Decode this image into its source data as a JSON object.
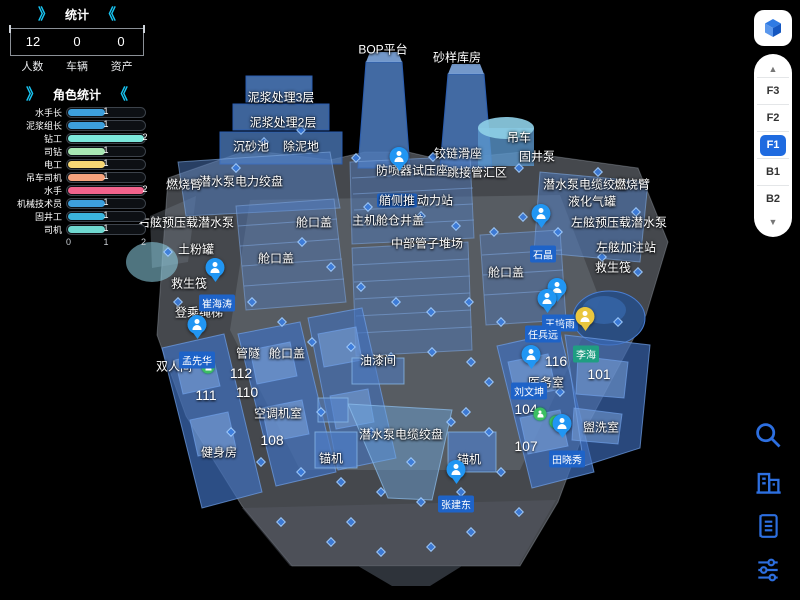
{
  "ui": {
    "chev_open": "》",
    "chev_close": "《",
    "up_arrow": "▲",
    "down_arrow": "▼"
  },
  "stats_panel": {
    "title": "统计",
    "items": [
      {
        "value": "12",
        "label": "人数"
      },
      {
        "value": "0",
        "label": "车辆"
      },
      {
        "value": "0",
        "label": "资产"
      }
    ]
  },
  "role_chart": {
    "title": "角色统计",
    "type": "bar",
    "x_max": 2,
    "x_ticks": [
      "0",
      "1",
      "2"
    ],
    "items": [
      {
        "label": "水手长",
        "value": 1,
        "color": "#3d9fdc"
      },
      {
        "label": "泥浆组长",
        "value": 1,
        "color": "#3d9fdc"
      },
      {
        "label": "钻工",
        "value": 2,
        "color": "#7ce8dc"
      },
      {
        "label": "司钻",
        "value": 1,
        "color": "#a9e8b4"
      },
      {
        "label": "电工",
        "value": 1,
        "color": "#f7d774"
      },
      {
        "label": "吊车司机",
        "value": 1,
        "color": "#f5a27c"
      },
      {
        "label": "水手",
        "value": 2,
        "color": "#f2638c"
      },
      {
        "label": "机械技术员",
        "value": 1,
        "color": "#3d9fdc"
      },
      {
        "label": "固井工",
        "value": 1,
        "color": "#3bb4dc"
      },
      {
        "label": "司机",
        "value": 1,
        "color": "#6fd8d0"
      }
    ]
  },
  "floor_selector": {
    "options": [
      {
        "label": "F3",
        "active": false
      },
      {
        "label": "F2",
        "active": false
      },
      {
        "label": "F1",
        "active": true
      },
      {
        "label": "B1",
        "active": false
      },
      {
        "label": "B2",
        "active": false
      }
    ],
    "active_color": "#1f6be0"
  },
  "toolbar": {
    "color": "#2d6fe0",
    "icons": [
      "search",
      "building",
      "list",
      "filters"
    ]
  },
  "map": {
    "labels": [
      {
        "t": "BOP平台",
        "x": 383,
        "y": 49
      },
      {
        "t": "砂样库房",
        "x": 457,
        "y": 57
      },
      {
        "t": "泥浆处理3层",
        "x": 281,
        "y": 97
      },
      {
        "t": "泥浆处理2层",
        "x": 283,
        "y": 122
      },
      {
        "t": "沉砂池",
        "x": 251,
        "y": 146
      },
      {
        "t": "除泥地",
        "x": 301,
        "y": 146
      },
      {
        "t": "吊车",
        "x": 519,
        "y": 137
      },
      {
        "t": "铰链滑座",
        "x": 458,
        "y": 153
      },
      {
        "t": "固井泵",
        "x": 537,
        "y": 156
      },
      {
        "t": "跳接管汇区",
        "x": 477,
        "y": 172
      },
      {
        "t": "防喷器试压座",
        "x": 412,
        "y": 170
      },
      {
        "t": "潜水泵电缆绞盘",
        "x": 585,
        "y": 184
      },
      {
        "t": "燃烧臂",
        "x": 632,
        "y": 184
      },
      {
        "t": "燃烧臂",
        "x": 184,
        "y": 184
      },
      {
        "t": "潜水泵电力绞盘",
        "x": 241,
        "y": 181
      },
      {
        "t": "液化气罐",
        "x": 592,
        "y": 201
      },
      {
        "t": "左舷预压载潜水泵",
        "x": 619,
        "y": 222
      },
      {
        "t": "右舷预压载潜水泵",
        "x": 186,
        "y": 222
      },
      {
        "t": "主机舱仓井盖",
        "x": 388,
        "y": 220
      },
      {
        "t": "动力站",
        "hl": "艏侧推",
        "x": 415,
        "y": 200
      },
      {
        "t": "中部管子堆场",
        "x": 427,
        "y": 243
      },
      {
        "t": "土粉罐",
        "x": 196,
        "y": 249
      },
      {
        "t": "舱口盖",
        "x": 314,
        "y": 222
      },
      {
        "t": "舱口盖",
        "x": 276,
        "y": 258
      },
      {
        "t": "舱口盖",
        "x": 506,
        "y": 272
      },
      {
        "t": "舱口盖",
        "x": 287,
        "y": 353
      },
      {
        "t": "左舷加注站",
        "x": 626,
        "y": 247
      },
      {
        "t": "救生筏",
        "x": 613,
        "y": 267
      },
      {
        "t": "救生筏",
        "x": 189,
        "y": 283
      },
      {
        "t": "登乘绳梯",
        "x": 199,
        "y": 312
      },
      {
        "t": "双人间",
        "x": 174,
        "y": 366
      },
      {
        "t": "管隧",
        "x": 248,
        "y": 353
      },
      {
        "t": "油漆间",
        "x": 378,
        "y": 360
      },
      {
        "t": "空调机室",
        "x": 278,
        "y": 413
      },
      {
        "t": "健身房",
        "x": 219,
        "y": 452
      },
      {
        "t": "锚机",
        "x": 331,
        "y": 458
      },
      {
        "t": "锚机",
        "x": 469,
        "y": 459
      },
      {
        "t": "潜水泵电缆绞盘",
        "x": 401,
        "y": 434
      },
      {
        "t": "医务室",
        "x": 546,
        "y": 382
      },
      {
        "t": "盥洗室",
        "x": 601,
        "y": 427
      },
      {
        "t": "112",
        "k": "n",
        "x": 241,
        "y": 373
      },
      {
        "t": "111",
        "k": "n",
        "x": 206,
        "y": 395
      },
      {
        "t": "110",
        "k": "n",
        "x": 247,
        "y": 392
      },
      {
        "t": "108",
        "k": "n",
        "x": 272,
        "y": 440
      },
      {
        "t": "116",
        "k": "n",
        "x": 556,
        "y": 361
      },
      {
        "t": "101",
        "k": "n",
        "x": 599,
        "y": 374
      },
      {
        "t": "104",
        "k": "n",
        "x": 526,
        "y": 409
      },
      {
        "t": "107",
        "k": "n",
        "x": 526,
        "y": 446
      }
    ],
    "persons": [
      {
        "name": "崔海涛",
        "pin": [
          215,
          277
        ],
        "label": [
          217,
          303
        ]
      },
      {
        "name": "孟先华",
        "pin": [
          197,
          334
        ],
        "label": [
          197,
          360
        ]
      },
      {
        "name": "石晶",
        "pin": [
          541,
          223
        ],
        "label": [
          543,
          254
        ]
      },
      {
        "name": "王培雨",
        "pin": [
          557,
          297
        ],
        "label": [
          560,
          323
        ]
      },
      {
        "name": "任兵远",
        "pin": [
          547,
          308
        ],
        "label": [
          543,
          334
        ]
      },
      {
        "name": "李海",
        "pin": [
          585,
          326
        ],
        "label": [
          586,
          354
        ],
        "pin_color": "#eac63e",
        "label_color": "#1f9e82"
      },
      {
        "name": "刘文坤",
        "pin": [
          531,
          364
        ],
        "label": [
          529,
          391
        ]
      },
      {
        "name": "田晓秀",
        "pin": [
          562,
          433
        ],
        "label": [
          567,
          459
        ]
      },
      {
        "name": "张建东",
        "pin": [
          456,
          479
        ],
        "label": [
          456,
          504
        ]
      },
      {
        "name": "",
        "pin": [
          399,
          166
        ],
        "label": null
      }
    ],
    "person_pin_color": "#2196f3",
    "person_label_color": "#1e63c8",
    "green_markers": [
      [
        208,
        367
      ],
      [
        540,
        414
      ],
      [
        556,
        422
      ]
    ],
    "crowd": [
      [
        236,
        168
      ],
      [
        264,
        142
      ],
      [
        301,
        130
      ],
      [
        356,
        158
      ],
      [
        433,
        157
      ],
      [
        519,
        168
      ],
      [
        598,
        172
      ],
      [
        636,
        212
      ],
      [
        368,
        207
      ],
      [
        421,
        216
      ],
      [
        456,
        226
      ],
      [
        494,
        232
      ],
      [
        523,
        217
      ],
      [
        558,
        232
      ],
      [
        602,
        257
      ],
      [
        638,
        272
      ],
      [
        302,
        242
      ],
      [
        331,
        267
      ],
      [
        361,
        287
      ],
      [
        396,
        302
      ],
      [
        431,
        312
      ],
      [
        469,
        302
      ],
      [
        501,
        322
      ],
      [
        252,
        302
      ],
      [
        282,
        322
      ],
      [
        312,
        342
      ],
      [
        351,
        347
      ],
      [
        391,
        357
      ],
      [
        432,
        352
      ],
      [
        471,
        362
      ],
      [
        231,
        432
      ],
      [
        261,
        462
      ],
      [
        301,
        472
      ],
      [
        341,
        482
      ],
      [
        381,
        492
      ],
      [
        421,
        502
      ],
      [
        461,
        492
      ],
      [
        501,
        472
      ],
      [
        281,
        522
      ],
      [
        331,
        542
      ],
      [
        381,
        552
      ],
      [
        431,
        547
      ],
      [
        471,
        532
      ],
      [
        519,
        512
      ],
      [
        351,
        522
      ],
      [
        560,
        392
      ],
      [
        618,
        322
      ],
      [
        178,
        302
      ],
      [
        168,
        252
      ],
      [
        451,
        422
      ],
      [
        489,
        432
      ],
      [
        411,
        462
      ],
      [
        371,
        432
      ],
      [
        321,
        412
      ],
      [
        489,
        382
      ],
      [
        466,
        412
      ]
    ]
  }
}
